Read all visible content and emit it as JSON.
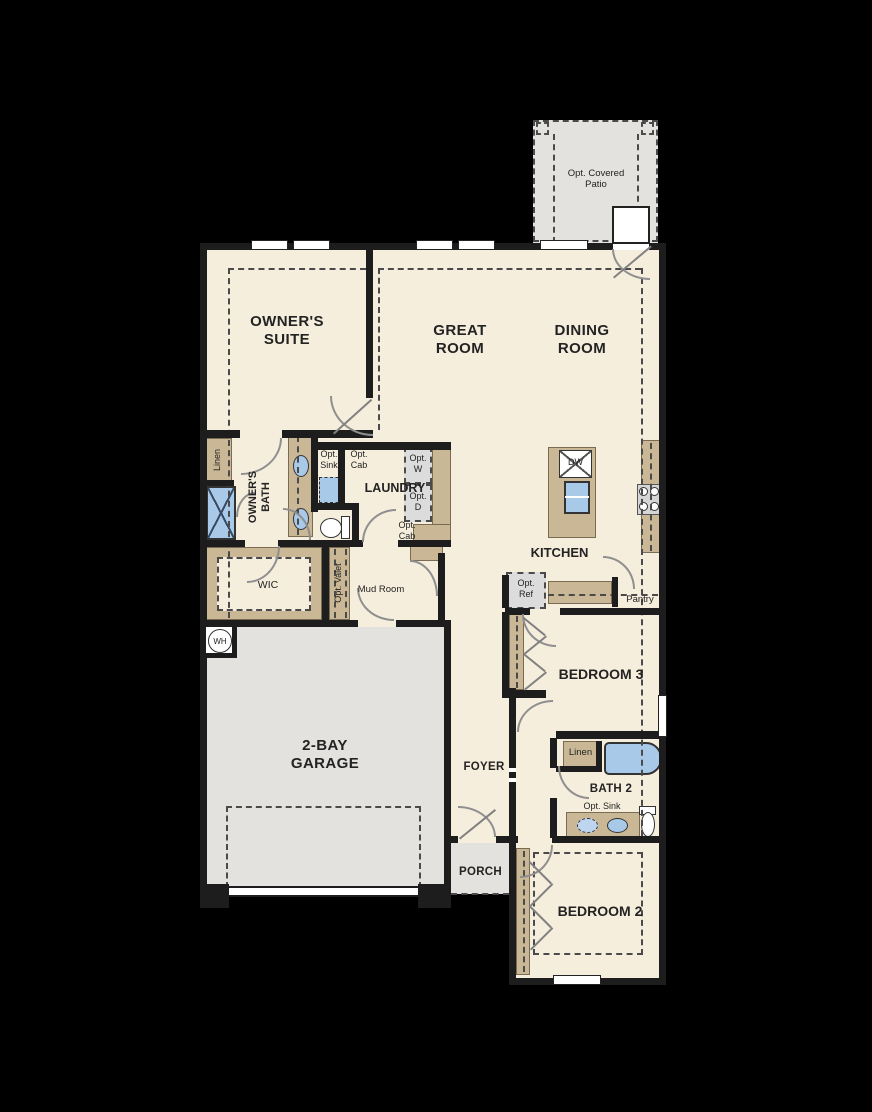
{
  "floorplan": {
    "labels": {
      "opt_covered_patio": "Opt. Covered\nPatio",
      "owners_suite": "OWNER'S\nSUITE",
      "great_room": "GREAT\nROOM",
      "dining_room": "DINING\nROOM",
      "linen_owners": "Linen",
      "owners_bath": "OWNER'S\nBATH",
      "opt_sink_laundry": "Opt.\nSink",
      "opt_cab_upper": "Opt.\nCab",
      "laundry": "LAUNDRY",
      "opt_w": "Opt.\nW",
      "opt_d": "Opt.\nD",
      "opt_cab_lower": "Opt.\nCab",
      "wic": "WIC",
      "opt_valet": "Opt. Valet",
      "mud_room": "Mud Room",
      "kitchen": "KITCHEN",
      "dw": "DW",
      "opt_ref": "Opt.\nRef",
      "pantry": "Pantry",
      "bedroom3": "BEDROOM 3",
      "linen_bath2": "Linen",
      "bath2": "BATH 2",
      "opt_sink_bath2": "Opt. Sink",
      "bedroom2": "BEDROOM 2",
      "garage": "2-BAY\nGARAGE",
      "foyer": "FOYER",
      "porch": "PORCH",
      "wh": "WH"
    },
    "colors": {
      "background": "#000000",
      "floor": "#f6eedd",
      "wall": "#1d1d1d",
      "cabinet_tan": "#c9b795",
      "fixture_blue": "#a9c9e9",
      "optional_gray": "#dcdcdc",
      "outdoor_gray": "#e3e2df"
    }
  }
}
